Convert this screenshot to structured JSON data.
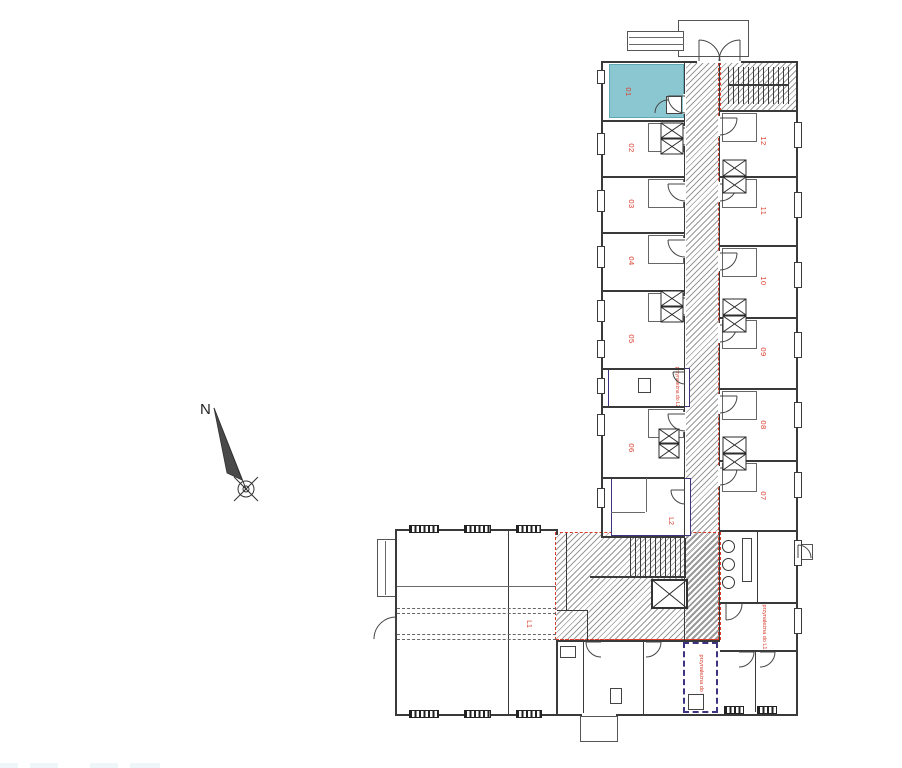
{
  "compass": {
    "label": "N"
  },
  "rooms": {
    "left": [
      {
        "number": "01",
        "highlighted": true
      },
      {
        "number": "02",
        "highlighted": false
      },
      {
        "number": "03",
        "highlighted": false
      },
      {
        "number": "04",
        "highlighted": false
      },
      {
        "number": "05",
        "highlighted": false
      },
      {
        "number": "06",
        "highlighted": false
      }
    ],
    "right": [
      {
        "number": "12",
        "highlighted": false
      },
      {
        "number": "11",
        "highlighted": false
      },
      {
        "number": "10",
        "highlighted": false
      },
      {
        "number": "09",
        "highlighted": false
      },
      {
        "number": "08",
        "highlighted": false
      },
      {
        "number": "07",
        "highlighted": false
      }
    ]
  },
  "units": {
    "l1_label": "L1",
    "l2_label": "L2"
  },
  "annotations": {
    "storage_mid_label": "przynależna do L2",
    "storage_bottom_label": "przynależna do L2",
    "storage_right_label": "przynależna do L1"
  },
  "colors": {
    "highlight_fill": "#8bc7d1",
    "annotation_red": "#d93b2b",
    "unit_outline_purple": "#3c3480",
    "wall_line": "#3a3a3a"
  }
}
